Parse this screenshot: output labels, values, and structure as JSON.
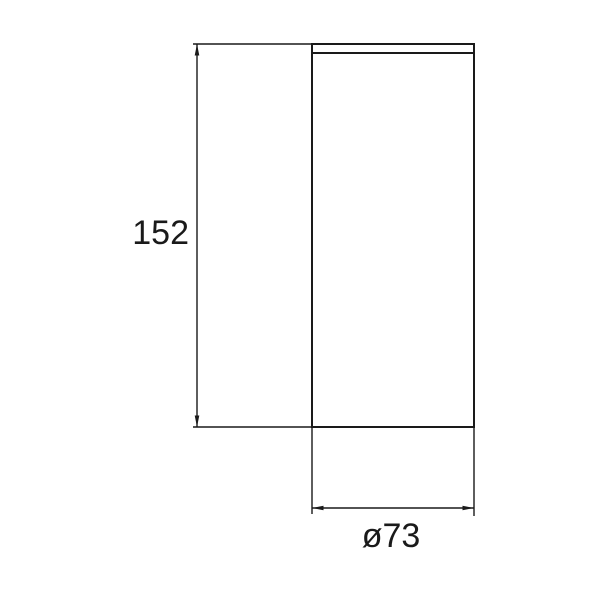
{
  "drawing": {
    "kind": "technical-dimension-drawing",
    "line_color": "#1a1a1a",
    "background_color": "#ffffff",
    "dimensions": {
      "height": {
        "label": "152",
        "value": 152
      },
      "diameter": {
        "label": "ø73",
        "value": 73
      }
    }
  }
}
